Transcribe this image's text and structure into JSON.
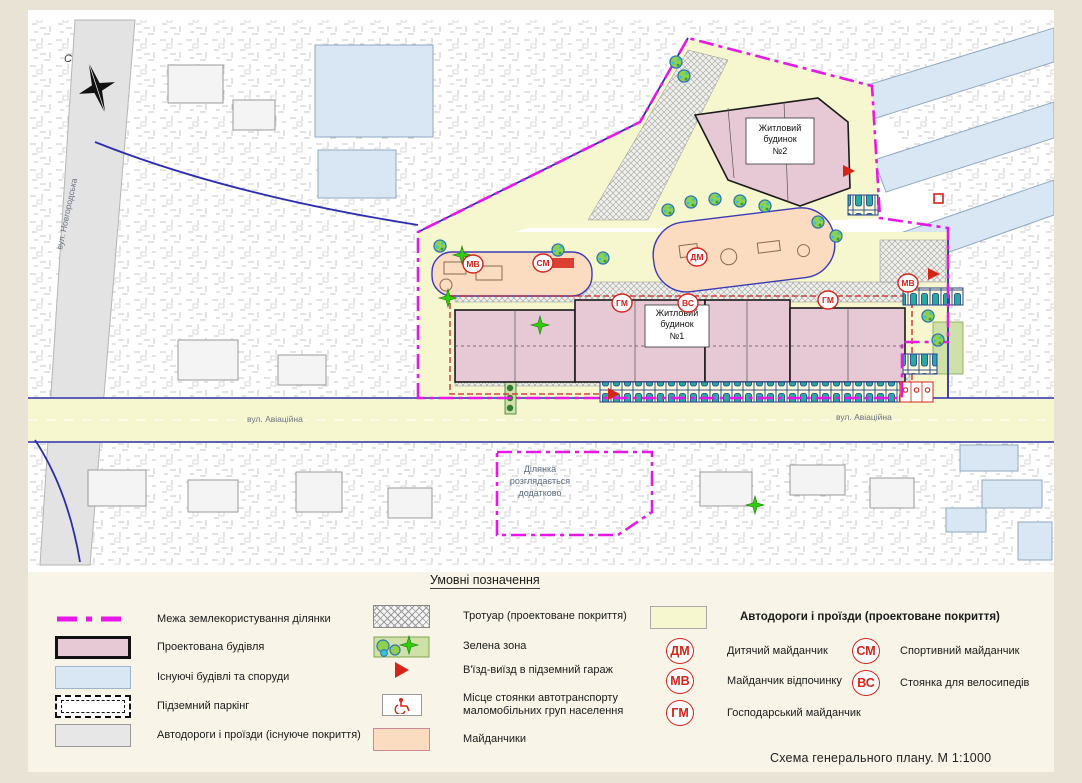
{
  "title": {
    "caption": "Схема  генерального плану. М 1:1000"
  },
  "colors": {
    "boundary_magenta": "#e718e7",
    "building_pink": "#e6c9d4",
    "existing_blue": "#d9e7f5",
    "road_yellow": "#f7f7cf",
    "playground_peach": "#fcdcc0",
    "green_zone": "#cfe0a8",
    "marker_red": "#d62418",
    "road_gray": "#e3e3e3",
    "edge_blue": "#2c2cb0"
  },
  "map": {
    "north_label": "С",
    "street_aviatsiina": "вул. Авіаційна",
    "street_novhorodska": "вул. Новгородська",
    "building1": {
      "l1": "Житловий",
      "l2": "будинок",
      "l3": "№1"
    },
    "building2": {
      "l1": "Житловий",
      "l2": "будинок",
      "l3": "№2"
    },
    "parcel_note": {
      "l1": "Ділянка",
      "l2": "розглядається",
      "l3": "додатково"
    },
    "badges": {
      "dm": "ДМ",
      "mv": "МВ",
      "hm": "ГМ",
      "sm": "СМ",
      "vs": "ВС"
    }
  },
  "legend": {
    "title": "Умовні позначення",
    "col1": [
      {
        "label": "Межа землекористування ділянки"
      },
      {
        "label": "Проектована будівля"
      },
      {
        "label": "Існуючі будівлі та споруди"
      },
      {
        "label": "Підземний паркінг"
      },
      {
        "label": "Автодороги і проїзди (існуюче покриття)"
      }
    ],
    "col2": [
      {
        "label": "Тротуар (проектоване покриття)"
      },
      {
        "label": "Зелена зона"
      },
      {
        "label": "В'їзд-виїзд в підземний гараж"
      },
      {
        "label_l1": "Місце стоянки автотранспорту",
        "label_l2": "маломобільних груп населення"
      },
      {
        "label": "Майданчики"
      }
    ],
    "road_proposed_label": "Автодороги і проїзди (проектоване покриття)",
    "badges": [
      {
        "code": "ДМ",
        "label": "Дитячий майданчик"
      },
      {
        "code": "МВ",
        "label": "Майданчик відпочинку"
      },
      {
        "code": "ГМ",
        "label": "Господарський майданчик"
      },
      {
        "code": "СМ",
        "label": "Спортивний майданчик"
      },
      {
        "code": "ВС",
        "label": "Стоянка для велосипедів"
      }
    ]
  }
}
